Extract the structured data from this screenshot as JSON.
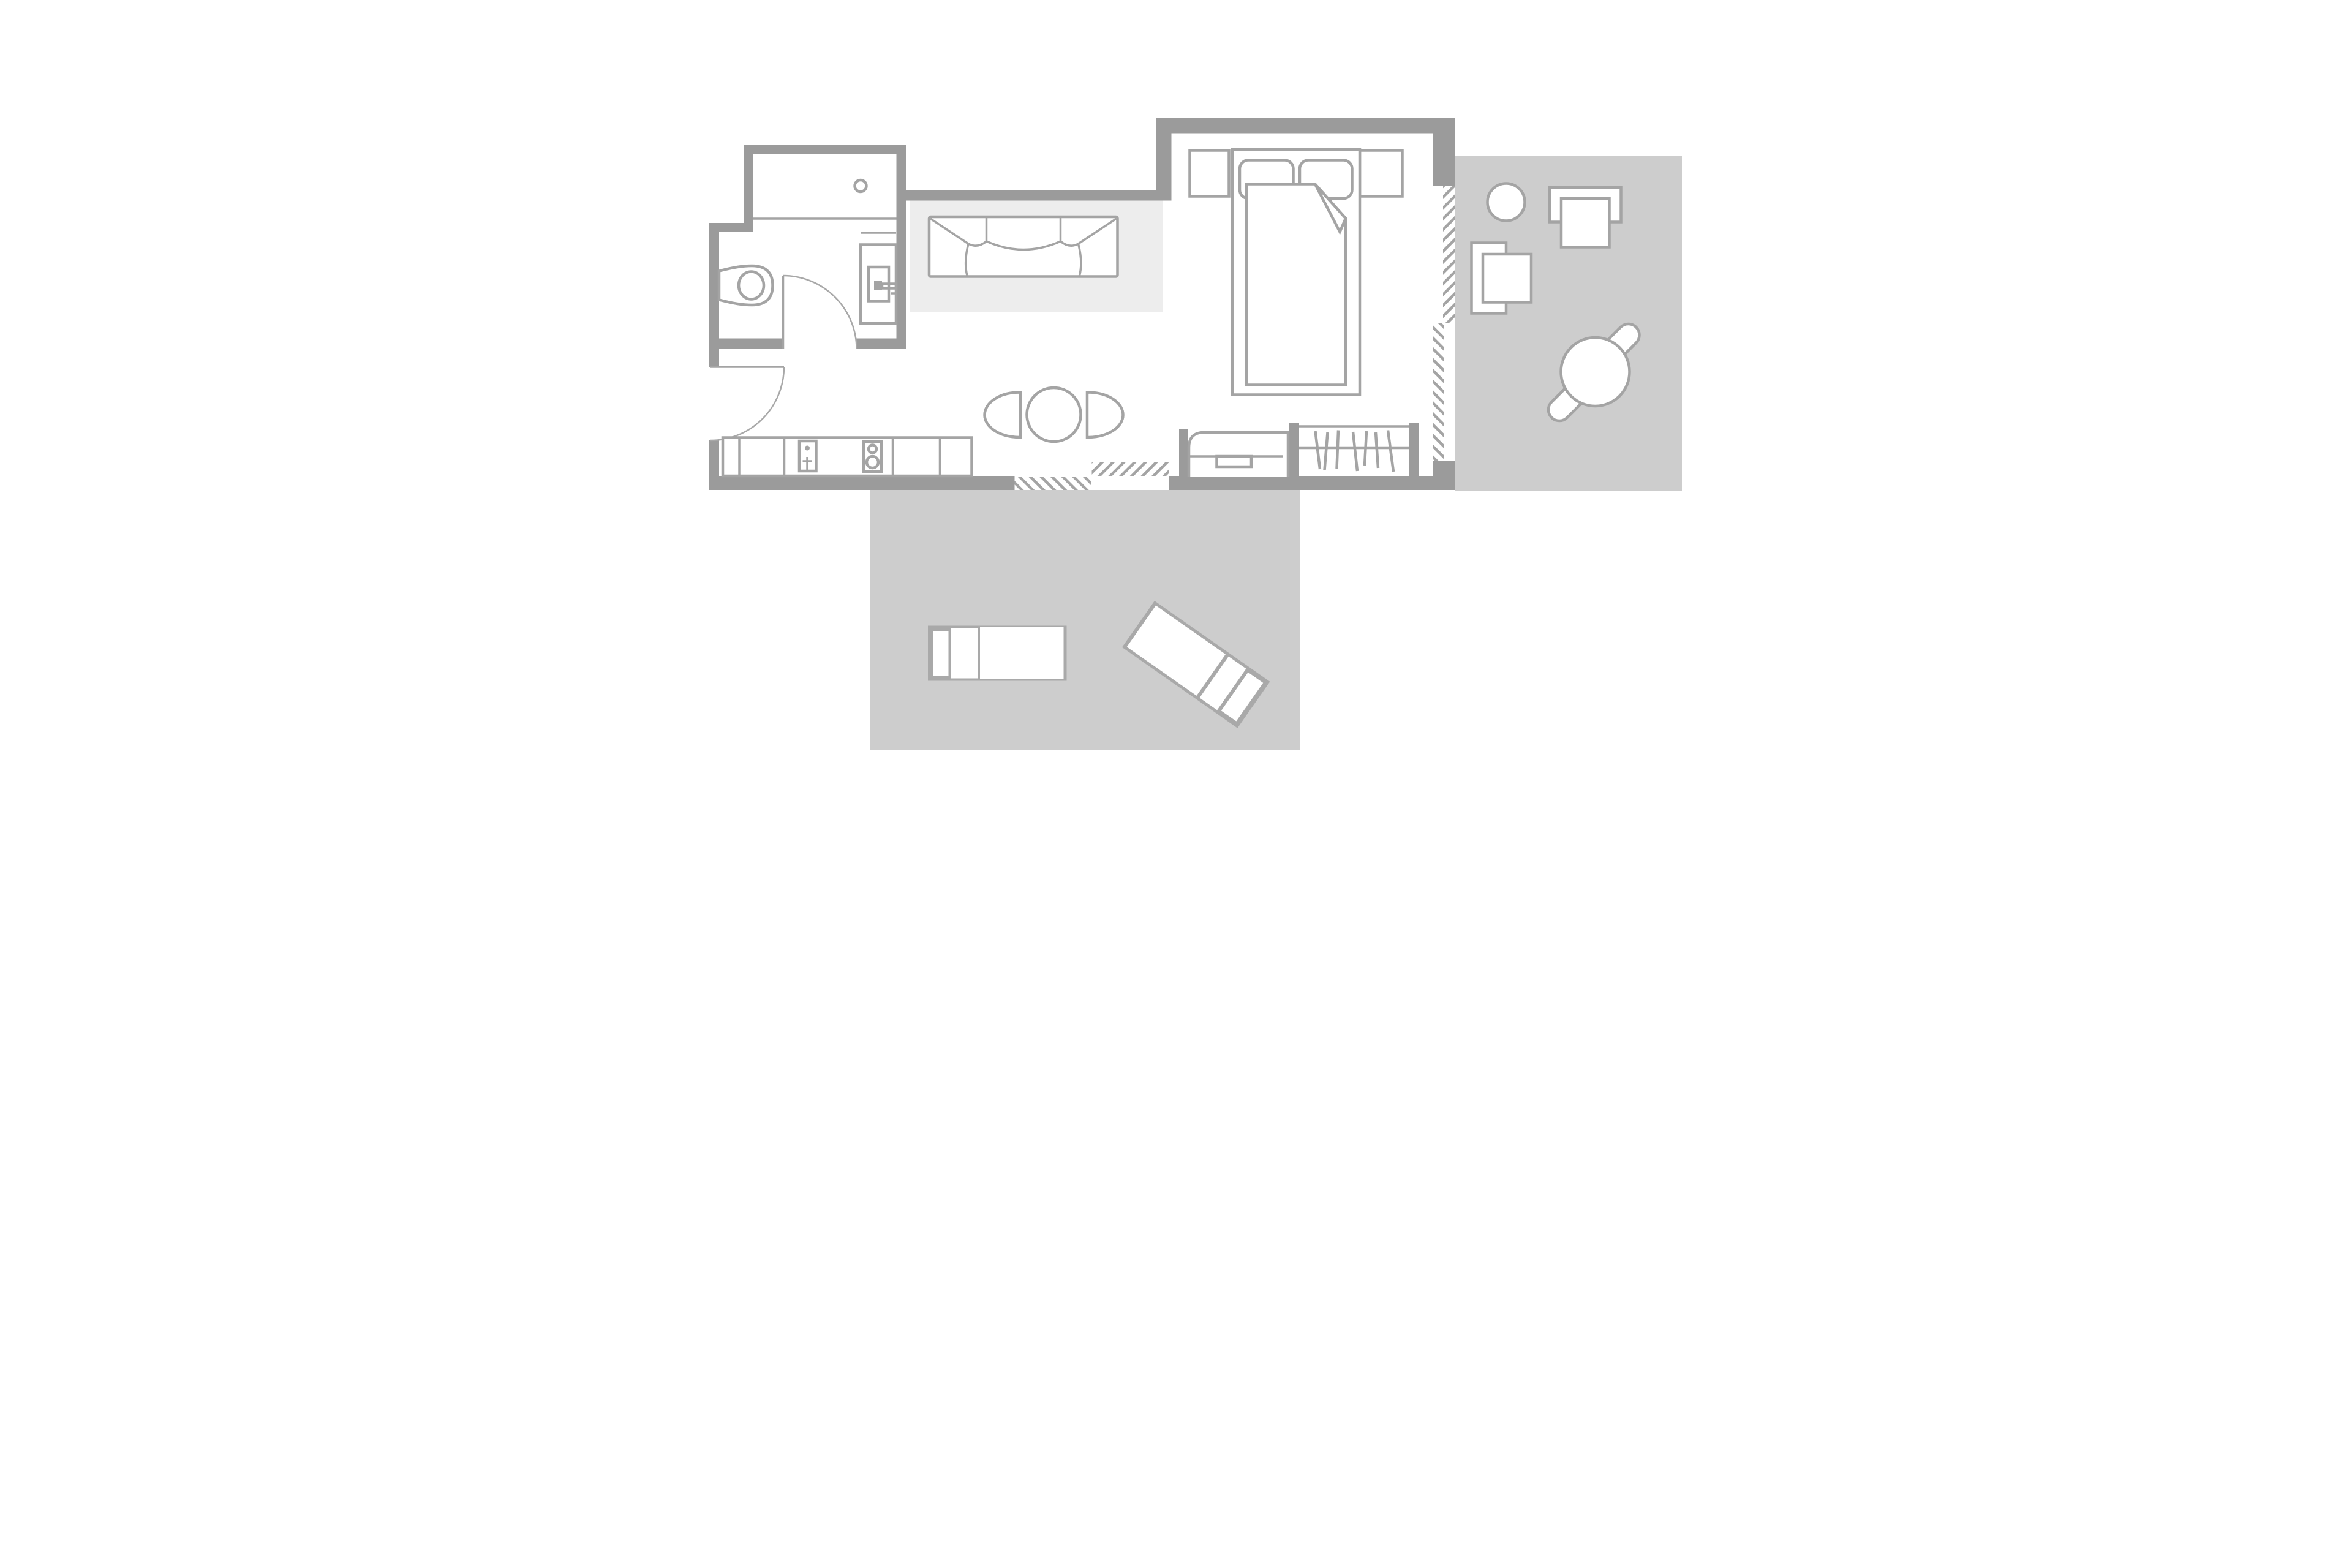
{
  "colors": {
    "background": "#ffffff",
    "wall": "#9b9b9b",
    "furniture": "#a4a4a4",
    "door": "#a8a8a8",
    "terrace": "#cdcdcd",
    "rug": "#ededed",
    "hatch": "#a4a4a4",
    "lounger_frame": "#a9a9a9",
    "fill_white": "#ffffff"
  },
  "plan": {
    "type": "floor-plan",
    "areas": [
      {
        "id": "bathroom",
        "furniture": [
          "bathtub",
          "bathtub-drain",
          "toilet",
          "washbasin",
          "vanity-shelf"
        ]
      },
      {
        "id": "entry-hall",
        "furniture": []
      },
      {
        "id": "kitchen",
        "furniture": [
          "kitchen-counter",
          "sink",
          "faucet-cross",
          "cooktop-two-burners"
        ]
      },
      {
        "id": "living-dining",
        "furniture": [
          "area-rug",
          "sofa-three-seat",
          "round-dining-table",
          "dining-chair-left",
          "dining-chair-right",
          "bench-daybed",
          "wardrobe-rail-with-hangers"
        ]
      },
      {
        "id": "bedroom",
        "furniture": [
          "double-bed",
          "pillow-left",
          "pillow-right",
          "duvet-folded-corner",
          "nightstand-left",
          "nightstand-right"
        ]
      },
      {
        "id": "side-terrace",
        "furniture": [
          "side-table-round",
          "armchair-facing-down",
          "armchair-facing-right",
          "round-terrace-table",
          "stool-upper-right",
          "stool-lower-left"
        ]
      },
      {
        "id": "lower-terrace",
        "furniture": [
          "sun-lounger-straight",
          "sun-lounger-angled"
        ]
      }
    ],
    "openings": [
      "entry-door-swing",
      "bathroom-door-swing",
      "sliding-glass-door-bottom",
      "sliding-glass-door-right"
    ],
    "window_marking": "diagonal-hatch"
  }
}
